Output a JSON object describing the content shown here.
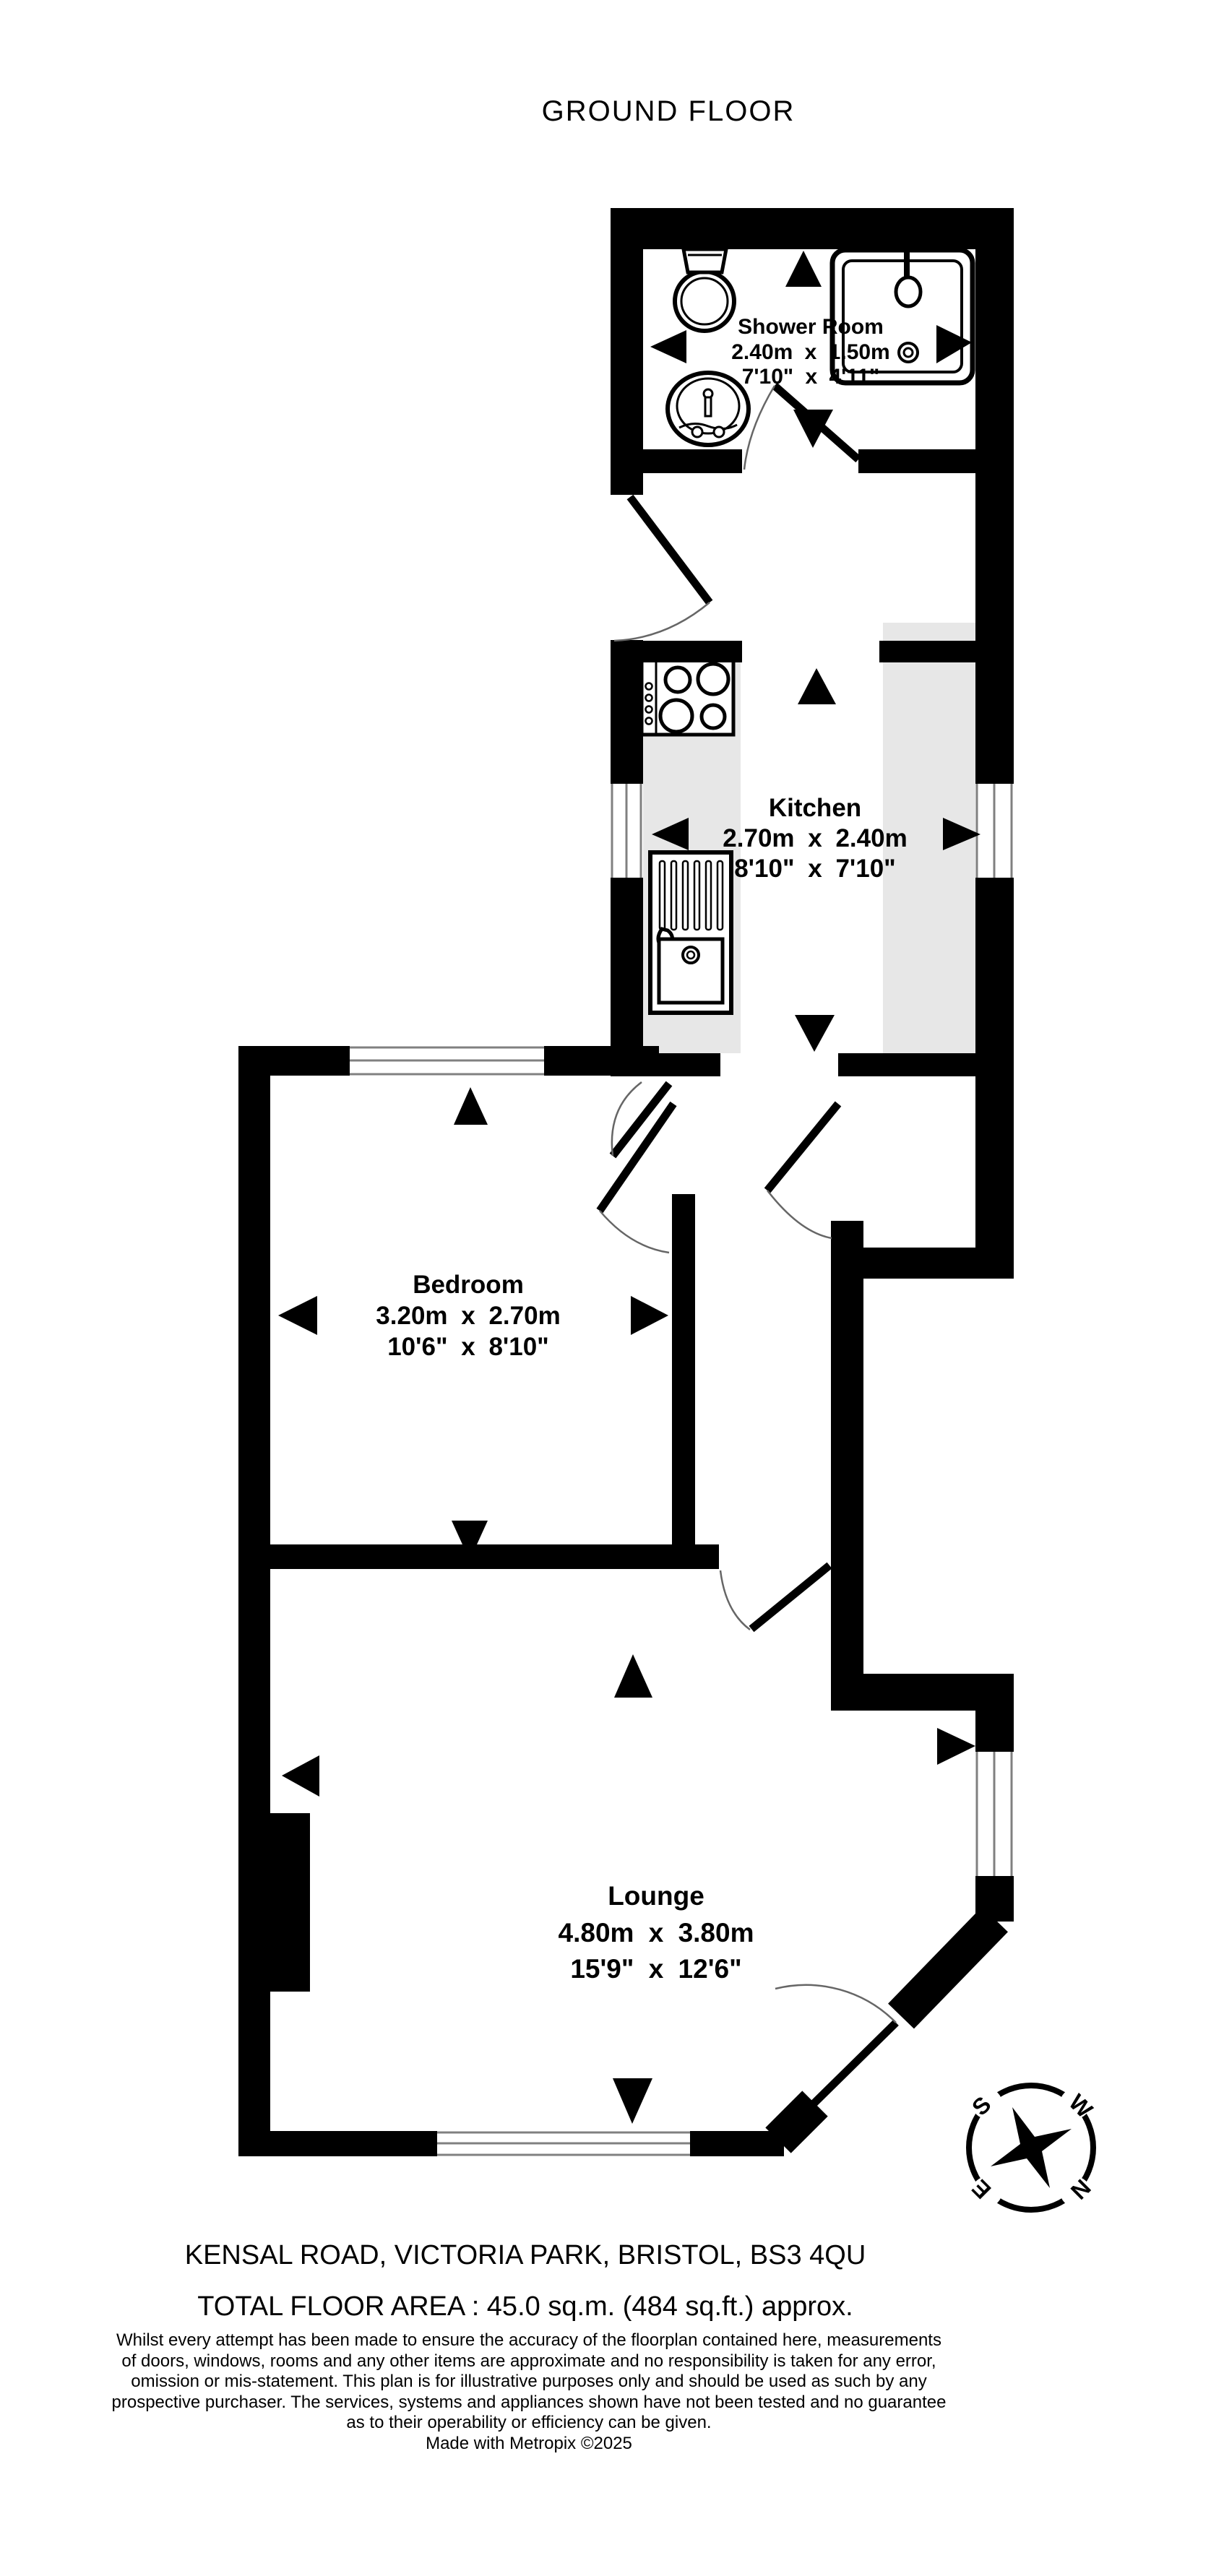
{
  "title": "GROUND FLOOR",
  "rooms": [
    {
      "name": "Shower Room",
      "metric": "2.40m x 1.50m",
      "imperial": "7'10\" x 4'11\""
    },
    {
      "name": "Kitchen",
      "metric": "2.70m x 2.40m",
      "imperial": "8'10\" x 7'10\""
    },
    {
      "name": "Bedroom",
      "metric": "3.20m x 2.70m",
      "imperial": "10'6\" x 8'10\""
    },
    {
      "name": "Lounge",
      "metric": "4.80m x 3.80m",
      "imperial": "15'9\" x 12'6\""
    }
  ],
  "compass": {
    "north": "N",
    "south": "S",
    "east": "E",
    "west": "W"
  },
  "footer": {
    "address": "KENSAL ROAD, VICTORIA PARK, BRISTOL, BS3 4QU",
    "total_area": "TOTAL FLOOR AREA : 45.0 sq.m. (484 sq.ft.) approx.",
    "disclaimer_lines": [
      "Whilst every attempt has been made to ensure the accuracy of the floorplan contained here, measurements",
      "of doors, windows, rooms and any other items are approximate and no responsibility is taken for any error,",
      "omission or mis-statement. This plan is for illustrative purposes only and should be used as such by any",
      "prospective purchaser. The services, systems and appliances shown have not been tested and no guarantee",
      "as to their operability or efficiency can be given."
    ],
    "credit": "Made with Metropix ©2025"
  },
  "colors": {
    "wall": "#000000",
    "counter": "#e7e7e7",
    "window_line": "#808080",
    "background": "#ffffff"
  }
}
